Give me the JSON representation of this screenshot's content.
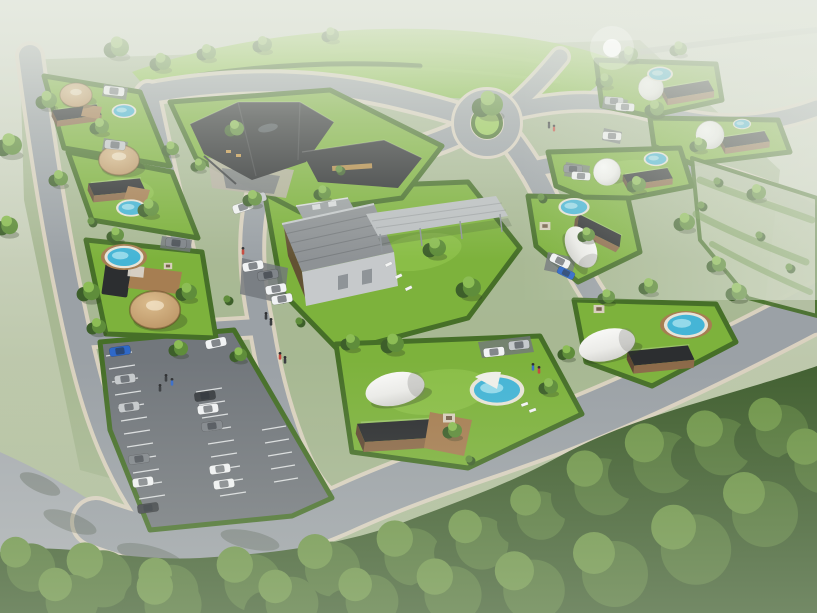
{
  "scene": {
    "description": "Aerial 3D architectural rendering of a glamping resort: winding gray roads with beige curbs, hedged green lots holding cabins, geodesic dome tents, white tunnel tents, round yurt cabins and private pools, a dark angular reception complex, a gray gabled barn with a long open canopy, a striped car park full of vehicles, dense forest along the bottom edge and a hazy meadow horizon at the top.",
    "counts": {
      "glamping_dome_tents": 3,
      "tunnel_tents": 3,
      "round_yurt_cabins": 3,
      "lodge_cabins": 9,
      "swimming_pools": 9,
      "vehicles": 30,
      "people": 12,
      "striped_parking_bays": 26
    }
  },
  "colors": {
    "haze_top": "#d6dbcd",
    "haze_veil": "#e7ebe2",
    "meadow": "#b6c3a2",
    "meadow_far": "#c8d0ba",
    "ground": "#a3b58e",
    "berm_top": "#9ccf56",
    "berm": "#7fb83e",
    "grass": "#7db23c",
    "grass_light": "#97ca52",
    "hedge": "#466f28",
    "tree_dark": "#3d5f2a",
    "tree_mid": "#5f8d3b",
    "tree_light": "#8cbd55",
    "forest_dark": "#426031",
    "forest_mid": "#56783c",
    "forest_light": "#6f9549",
    "road": "#9ba1a6",
    "road_light": "#a8adb1",
    "curb": "#dbd2c1",
    "asphalt": "#72777c",
    "stripe": "#eceef0",
    "pond": "#b8bdba",
    "roof_dark": "#2c2e30",
    "barn_roof": "#8e9295",
    "barn_wall": "#c6c9cb",
    "canopy": "#bcc0c2",
    "wood": "#8c6a49",
    "wood_dark": "#5f4732",
    "deck": "#a67e52",
    "yurt": "#b58d5e",
    "yurt_light": "#dbbc8d",
    "dome": "#f0f0ee",
    "dome_shade": "#c9c9c5",
    "tent": "#ebebe8",
    "pool_rim": "#e8e4d8",
    "pool_water": "#45b5d6",
    "pool_glint": "#a8e2ef",
    "pad": "#d8cfbd",
    "car_white": "#f1f3f4",
    "car_silver": "#c5c9cc",
    "car_gray": "#80858a",
    "car_dark": "#3b3f43",
    "car_blue": "#2e68c8",
    "window_warm": "#e2a94e",
    "person": "#3a3d40",
    "person_red": "#c64a3e",
    "person_blue": "#3b6fc9",
    "shadow": "rgba(45,60,38,0.30)"
  }
}
